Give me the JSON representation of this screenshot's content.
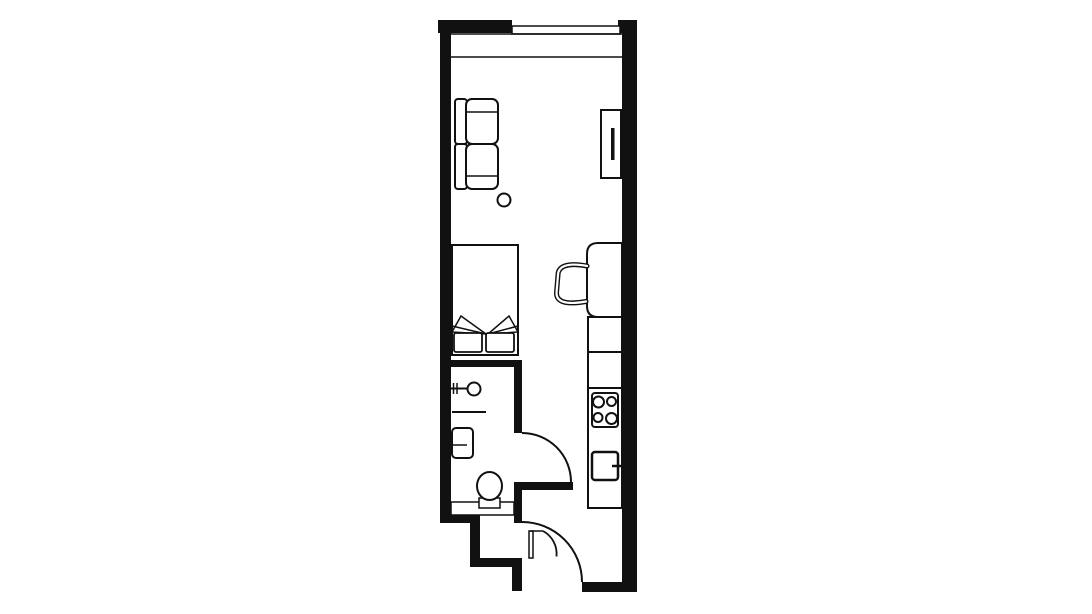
{
  "canvas": {
    "width": 1092,
    "height": 614,
    "background": "#ffffff",
    "ink": "#111111"
  },
  "floorplan": {
    "description": "studio-apartment-floor-plan",
    "elements": [
      {
        "kind": "rect",
        "name": "left-wall",
        "x": 440,
        "y": 20,
        "w": 11,
        "h": 503,
        "fill": "ink"
      },
      {
        "kind": "rect",
        "name": "top-wall-left",
        "x": 438,
        "y": 20,
        "w": 74,
        "h": 13,
        "fill": "ink"
      },
      {
        "kind": "rect",
        "name": "top-wall-right",
        "x": 618,
        "y": 20,
        "w": 19,
        "h": 13,
        "fill": "ink"
      },
      {
        "kind": "rect",
        "name": "right-wall",
        "x": 622,
        "y": 20,
        "w": 15,
        "h": 572,
        "fill": "ink"
      },
      {
        "kind": "rect",
        "name": "bathroom-top-wall",
        "x": 440,
        "y": 360,
        "w": 82,
        "h": 7,
        "fill": "ink"
      },
      {
        "kind": "rect",
        "name": "bathroom-right-wall-upper",
        "x": 514,
        "y": 360,
        "w": 8,
        "h": 73,
        "fill": "ink"
      },
      {
        "kind": "rect",
        "name": "hallway-top-wall",
        "x": 514,
        "y": 482,
        "w": 59,
        "h": 8,
        "fill": "ink"
      },
      {
        "kind": "rect",
        "name": "bathroom-right-wall-lower",
        "x": 514,
        "y": 482,
        "w": 8,
        "h": 41,
        "fill": "ink"
      },
      {
        "kind": "rect",
        "name": "bathroom-bottom-wall",
        "x": 440,
        "y": 515,
        "w": 40,
        "h": 8,
        "fill": "ink"
      },
      {
        "kind": "rect",
        "name": "entry-step-wall-vertical-1",
        "x": 470,
        "y": 515,
        "w": 10,
        "h": 52,
        "fill": "ink"
      },
      {
        "kind": "rect",
        "name": "entry-step-wall-horizontal",
        "x": 470,
        "y": 558,
        "w": 52,
        "h": 9,
        "fill": "ink"
      },
      {
        "kind": "rect",
        "name": "entry-step-wall-vertical-2",
        "x": 512,
        "y": 558,
        "w": 10,
        "h": 33,
        "fill": "ink"
      },
      {
        "kind": "rect",
        "name": "bottom-wall",
        "x": 582,
        "y": 582,
        "w": 55,
        "h": 10,
        "fill": "ink"
      },
      {
        "kind": "rect",
        "name": "window",
        "x": 512,
        "y": 26,
        "w": 108,
        "h": 8,
        "fill": "white",
        "stroke": "ink",
        "sw": 1.5
      },
      {
        "kind": "line",
        "name": "under-window-line",
        "x1": 451,
        "y1": 34,
        "x2": 622,
        "y2": 34,
        "sw": 1.5
      },
      {
        "kind": "line",
        "name": "ledge-line",
        "x1": 451,
        "y1": 57,
        "x2": 622,
        "y2": 57,
        "sw": 1.5
      },
      {
        "kind": "rect",
        "name": "sofa-back-upper",
        "x": 455,
        "y": 99,
        "w": 12,
        "h": 45,
        "rx": 3,
        "fill": "white",
        "stroke": "ink",
        "sw": 2
      },
      {
        "kind": "rect",
        "name": "sofa-back-lower",
        "x": 455,
        "y": 144,
        "w": 12,
        "h": 45,
        "rx": 3,
        "fill": "white",
        "stroke": "ink",
        "sw": 2
      },
      {
        "kind": "rect",
        "name": "sofa-seat-upper",
        "x": 466,
        "y": 99,
        "w": 32,
        "h": 45,
        "rx": 6,
        "fill": "white",
        "stroke": "ink",
        "sw": 2
      },
      {
        "kind": "line",
        "name": "sofa-seat-upper-armline",
        "x1": 467,
        "y1": 112,
        "x2": 497,
        "y2": 112,
        "sw": 1.5
      },
      {
        "kind": "rect",
        "name": "sofa-seat-lower",
        "x": 466,
        "y": 144,
        "w": 32,
        "h": 45,
        "rx": 6,
        "fill": "white",
        "stroke": "ink",
        "sw": 2
      },
      {
        "kind": "line",
        "name": "sofa-seat-lower-armline",
        "x1": 467,
        "y1": 176,
        "x2": 497,
        "y2": 176,
        "sw": 1.5
      },
      {
        "kind": "circle",
        "name": "side-table",
        "cx": 504,
        "cy": 200,
        "r": 6.5,
        "fill": "white",
        "stroke": "ink",
        "sw": 2
      },
      {
        "kind": "rect",
        "name": "tv-board",
        "x": 601,
        "y": 110,
        "w": 20,
        "h": 68,
        "fill": "white",
        "stroke": "ink",
        "sw": 2
      },
      {
        "kind": "rect",
        "name": "tv-screen",
        "x": 611,
        "y": 128,
        "w": 3.5,
        "h": 32,
        "fill": "ink"
      },
      {
        "kind": "rect",
        "name": "bed",
        "x": 452,
        "y": 245,
        "w": 66,
        "h": 110,
        "fill": "white",
        "stroke": "ink",
        "sw": 2
      },
      {
        "kind": "polygon",
        "name": "duvet-fold-left",
        "points": "452,332 461,316 486,334",
        "fill": "white",
        "stroke": "ink",
        "sw": 1.5
      },
      {
        "kind": "line",
        "name": "duvet-fold-left-line",
        "x1": 452,
        "y1": 326,
        "x2": 486,
        "y2": 334,
        "sw": 1.5
      },
      {
        "kind": "polygon",
        "name": "duvet-fold-right",
        "points": "518,332 509,316 488,334",
        "fill": "white",
        "stroke": "ink",
        "sw": 1.5
      },
      {
        "kind": "line",
        "name": "duvet-fold-right-line",
        "x1": 518,
        "y1": 326,
        "x2": 488,
        "y2": 334,
        "sw": 1.5
      },
      {
        "kind": "rect",
        "name": "pillow-left",
        "x": 454,
        "y": 333,
        "w": 28,
        "h": 19,
        "rx": 2,
        "fill": "white",
        "stroke": "ink",
        "sw": 1.8
      },
      {
        "kind": "rect",
        "name": "pillow-right",
        "x": 486,
        "y": 333,
        "w": 28,
        "h": 19,
        "rx": 2,
        "fill": "white",
        "stroke": "ink",
        "sw": 1.8
      },
      {
        "kind": "path",
        "name": "desk",
        "d": "M 622,243 L 598,243 Q 587,243 587,254 L 587,306 Q 587,317 598,317 L 622,317 Z",
        "fill": "white",
        "stroke": "ink",
        "sw": 2
      },
      {
        "kind": "path",
        "name": "desk-chair-outer",
        "d": "M 587,266 C 566,262 558,267 558,275 L 556.5,293 C 556.5,302 566,305 586,301.5",
        "fill": "none",
        "stroke": "ink",
        "sw": 5,
        "cap": "round"
      },
      {
        "kind": "path",
        "name": "desk-chair-inner",
        "d": "M 587,266 C 566,262 558,267 558,275 L 556.5,293 C 556.5,302 566,305 586,301.5",
        "fill": "none",
        "stroke": "white",
        "sw": 2.2,
        "cap": "round"
      },
      {
        "kind": "rect",
        "name": "kitchen-cabinet-upper",
        "x": 588,
        "y": 317,
        "w": 34,
        "h": 35,
        "fill": "white",
        "stroke": "ink",
        "sw": 2
      },
      {
        "kind": "rect",
        "name": "kitchen-cabinet-lower",
        "x": 588,
        "y": 352,
        "w": 34,
        "h": 36,
        "fill": "white",
        "stroke": "ink",
        "sw": 2
      },
      {
        "kind": "rect",
        "name": "kitchen-counter",
        "x": 588,
        "y": 388,
        "w": 34,
        "h": 120,
        "fill": "white",
        "stroke": "ink",
        "sw": 2
      },
      {
        "kind": "rect",
        "name": "stove",
        "x": 592,
        "y": 393,
        "w": 26,
        "h": 34,
        "rx": 3,
        "fill": "white",
        "stroke": "ink",
        "sw": 2
      },
      {
        "kind": "circle",
        "name": "burner-top-left",
        "cx": 598.5,
        "cy": 402,
        "r": 5.5,
        "fill": "white",
        "stroke": "ink",
        "sw": 2
      },
      {
        "kind": "circle",
        "name": "burner-top-right",
        "cx": 611.5,
        "cy": 401.5,
        "r": 4.5,
        "fill": "white",
        "stroke": "ink",
        "sw": 2
      },
      {
        "kind": "circle",
        "name": "burner-bottom-left",
        "cx": 598,
        "cy": 417.5,
        "r": 4.5,
        "fill": "white",
        "stroke": "ink",
        "sw": 2
      },
      {
        "kind": "circle",
        "name": "burner-bottom-right",
        "cx": 611.5,
        "cy": 418.5,
        "r": 5.5,
        "fill": "white",
        "stroke": "ink",
        "sw": 2
      },
      {
        "kind": "rect",
        "name": "kitchen-sink",
        "x": 592,
        "y": 452,
        "w": 26,
        "h": 28,
        "rx": 3,
        "fill": "white",
        "stroke": "ink",
        "sw": 2.5
      },
      {
        "kind": "line",
        "name": "kitchen-faucet",
        "x1": 612,
        "y1": 466,
        "x2": 621,
        "y2": 466,
        "sw": 2.5
      },
      {
        "kind": "line",
        "name": "basin-wall-tick-1",
        "x1": 453.5,
        "y1": 383,
        "x2": 453.5,
        "y2": 394,
        "sw": 1.5
      },
      {
        "kind": "line",
        "name": "basin-wall-tick-2",
        "x1": 457,
        "y1": 383,
        "x2": 457,
        "y2": 394,
        "sw": 1.5
      },
      {
        "kind": "line",
        "name": "basin-arm",
        "x1": 451,
        "y1": 388.5,
        "x2": 468,
        "y2": 388.5,
        "sw": 2
      },
      {
        "kind": "circle",
        "name": "wash-basin",
        "cx": 474,
        "cy": 389,
        "r": 6.5,
        "fill": "white",
        "stroke": "ink",
        "sw": 2
      },
      {
        "kind": "line",
        "name": "towel-rail-line",
        "x1": 452,
        "y1": 412,
        "x2": 486,
        "y2": 412,
        "sw": 2
      },
      {
        "kind": "rect",
        "name": "washing-machine",
        "x": 452,
        "y": 428,
        "w": 21,
        "h": 30,
        "rx": 4,
        "fill": "white",
        "stroke": "ink",
        "sw": 2
      },
      {
        "kind": "line",
        "name": "washing-machine-line",
        "x1": 453,
        "y1": 445,
        "x2": 467,
        "y2": 445,
        "sw": 1.5
      },
      {
        "kind": "rect",
        "name": "bathroom-counter",
        "x": 451,
        "y": 502,
        "w": 63,
        "h": 13,
        "fill": "white",
        "stroke": "ink",
        "sw": 1.5
      },
      {
        "kind": "rect",
        "name": "toilet-tank",
        "x": 479,
        "y": 498,
        "w": 21,
        "h": 10,
        "fill": "white",
        "stroke": "ink",
        "sw": 1.5
      },
      {
        "kind": "ellipse",
        "name": "toilet-bowl",
        "cx": 489.5,
        "cy": 486,
        "rx": 12.5,
        "ry": 14,
        "fill": "white",
        "stroke": "ink",
        "sw": 2
      },
      {
        "kind": "path",
        "name": "bathroom-door-arc",
        "d": "M 522,433 A 49 49 0 0 1 571,482",
        "fill": "none",
        "stroke": "ink",
        "sw": 2
      },
      {
        "kind": "path",
        "name": "entry-door-arc",
        "d": "M 522,522 A 60 60 0 0 1 582,582",
        "fill": "none",
        "stroke": "ink",
        "sw": 2
      },
      {
        "kind": "rect",
        "name": "closet-door-leaf",
        "x": 529,
        "y": 531,
        "w": 4,
        "h": 27,
        "fill": "white",
        "stroke": "ink",
        "sw": 1.5
      },
      {
        "kind": "line",
        "name": "closet-door-top-line",
        "x1": 530,
        "y1": 531,
        "x2": 543,
        "y2": 531,
        "sw": 1.5
      },
      {
        "kind": "path",
        "name": "closet-door-arc",
        "d": "M 543,531 A 26 26 0 0 1 556.5,556.5",
        "fill": "none",
        "stroke": "ink",
        "sw": 1.8
      }
    ]
  }
}
